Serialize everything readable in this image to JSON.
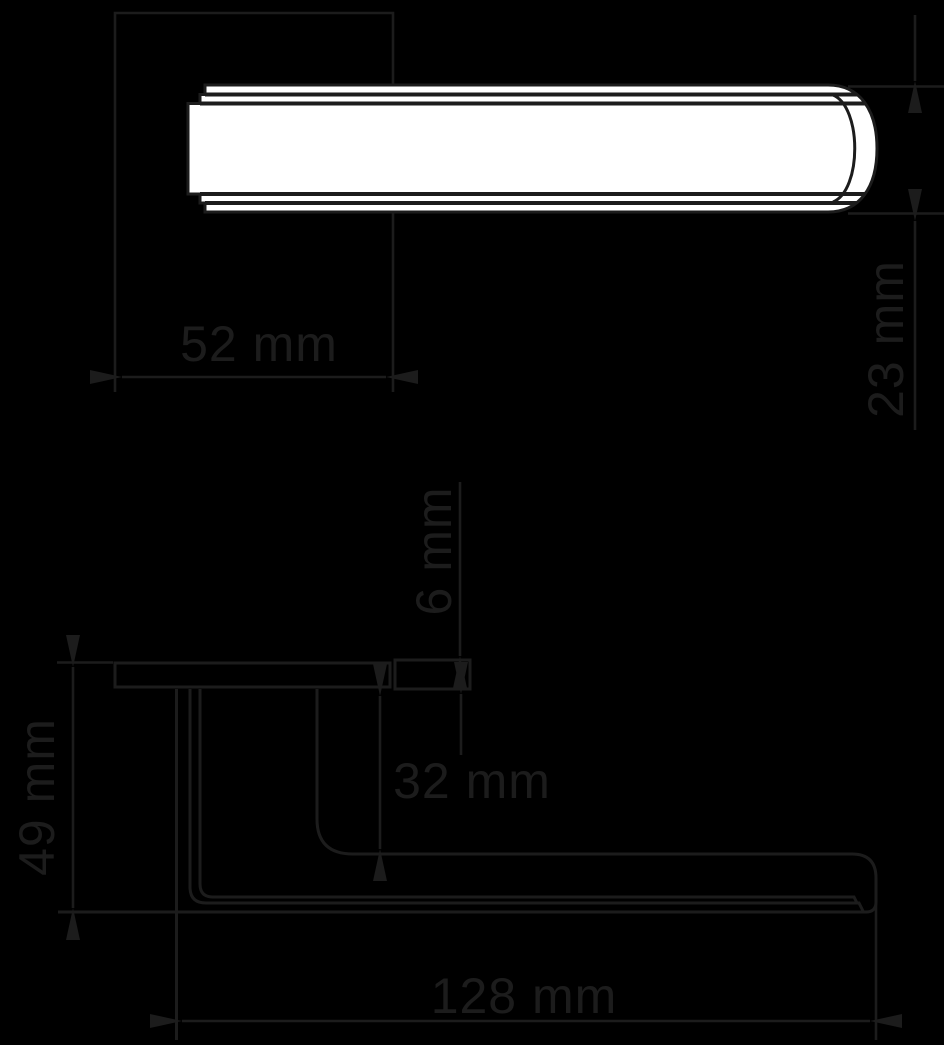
{
  "drawing": {
    "title": "door-lever-handle-dimension-drawing",
    "views": {
      "top_view": {
        "width_label": "52 mm",
        "thickness_label": "23 mm"
      },
      "side_view": {
        "plate_thickness_label": "6 mm",
        "clearance_label": "32 mm",
        "height_label": "49 mm",
        "length_label": "128 mm"
      }
    }
  },
  "colors": {
    "background": "#000000",
    "ink": "#1c1c1c",
    "fill": "#ffffff"
  }
}
